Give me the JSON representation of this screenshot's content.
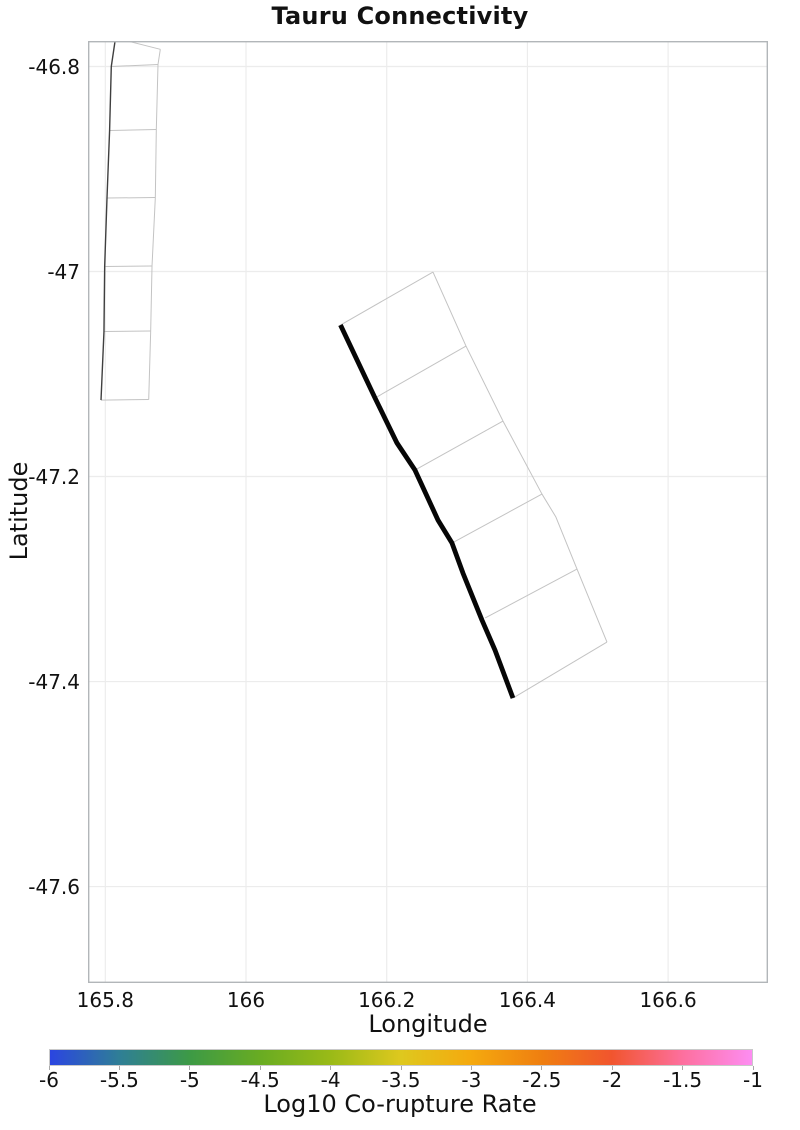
{
  "chart_data": {
    "type": "line",
    "title": "Tauru Connectivity",
    "xlabel": "Longitude",
    "ylabel": "Latitude",
    "xlim": [
      165.7754,
      166.742
    ],
    "ylim": [
      -47.6941,
      -46.7751
    ],
    "xticks": [
      165.8,
      166.0,
      166.2,
      166.4,
      166.6
    ],
    "xtick_labels": [
      "165.8",
      "166",
      "166.2",
      "166.4",
      "166.6"
    ],
    "yticks": [
      -46.8,
      -47.0,
      -47.2,
      -47.4,
      -47.6
    ],
    "ytick_labels": [
      "-46.8",
      "-47",
      "-47.2",
      "-47.4",
      "-47.6"
    ],
    "grid": true,
    "legend": "none",
    "styles": {
      "grid_color": "#ececec",
      "frame_color": "#b2b6b9",
      "mesh_color": "#c3c3c3",
      "thin_trace_color": "#3f3f3f",
      "thick_trace_color": "#060606"
    },
    "series": [
      {
        "name": "west-fault-outline-edge",
        "kind": "polyline",
        "color": "#c3c3c3",
        "width": 1,
        "points": [
          [
            165.8782,
            -46.7832
          ],
          [
            165.8749,
            -46.798
          ],
          [
            165.8725,
            -46.8615
          ],
          [
            165.8711,
            -46.9278
          ],
          [
            165.8664,
            -46.9946
          ],
          [
            165.8645,
            -47.058
          ],
          [
            165.8617,
            -47.1249
          ]
        ]
      },
      {
        "name": "west-fault-rungs",
        "kind": "segments",
        "color": "#c3c3c3",
        "width": 1,
        "segments": [
          [
            [
              165.8145,
              -46.7722
            ],
            [
              165.8782,
              -46.7832
            ]
          ],
          [
            [
              165.8085,
              -46.8
            ],
            [
              165.8749,
              -46.798
            ]
          ],
          [
            [
              165.8061,
              -46.8624
            ],
            [
              165.8725,
              -46.8615
            ]
          ],
          [
            [
              165.8024,
              -46.9283
            ],
            [
              165.8711,
              -46.9278
            ]
          ],
          [
            [
              165.7991,
              -46.9951
            ],
            [
              165.8664,
              -46.9946
            ]
          ],
          [
            [
              165.7981,
              -47.0585
            ],
            [
              165.8645,
              -47.058
            ]
          ],
          [
            [
              165.7939,
              -47.1254
            ],
            [
              165.8617,
              -47.1249
            ]
          ]
        ]
      },
      {
        "name": "west-fault-trace",
        "kind": "polyline",
        "color": "#3f3f3f",
        "width": 1.4,
        "points": [
          [
            165.8145,
            -46.7722
          ],
          [
            165.8085,
            -46.8
          ],
          [
            165.8061,
            -46.8624
          ],
          [
            165.8024,
            -46.9283
          ],
          [
            165.7991,
            -46.9951
          ],
          [
            165.7981,
            -47.0585
          ],
          [
            165.7939,
            -47.1254
          ]
        ]
      },
      {
        "name": "tauru-fault-outline-edge",
        "kind": "polyline",
        "color": "#c3c3c3",
        "width": 1,
        "points": [
          [
            166.2658,
            -47.0005
          ],
          [
            166.3127,
            -47.0727
          ],
          [
            166.3653,
            -47.1459
          ],
          [
            166.4207,
            -47.2171
          ],
          [
            166.4405,
            -47.2395
          ],
          [
            166.4705,
            -47.2903
          ],
          [
            166.5131,
            -47.3615
          ]
        ]
      },
      {
        "name": "tauru-fault-rungs",
        "kind": "segments",
        "color": "#c3c3c3",
        "width": 1,
        "segments": [
          [
            [
              166.1343,
              -47.0522
            ],
            [
              166.2658,
              -47.0005
            ]
          ],
          [
            [
              166.1834,
              -47.1234
            ],
            [
              166.3127,
              -47.0727
            ]
          ],
          [
            [
              166.2402,
              -47.1937
            ],
            [
              166.3653,
              -47.1459
            ]
          ],
          [
            [
              166.2928,
              -47.2649
            ],
            [
              166.4207,
              -47.2171
            ]
          ],
          [
            [
              166.34,
              -47.338
            ],
            [
              166.4705,
              -47.2903
            ]
          ],
          [
            [
              166.3795,
              -47.4161
            ],
            [
              166.5131,
              -47.3615
            ]
          ]
        ]
      },
      {
        "name": "tauru-fault-trace",
        "kind": "polyline",
        "color": "#060606",
        "width": 4.8,
        "points": [
          [
            166.1343,
            -47.0522
          ],
          [
            166.1834,
            -47.1234
          ],
          [
            166.2146,
            -47.1673
          ],
          [
            166.2402,
            -47.1937
          ],
          [
            166.2729,
            -47.2425
          ],
          [
            166.2928,
            -47.2649
          ],
          [
            166.3084,
            -47.2942
          ],
          [
            166.3354,
            -47.34
          ],
          [
            166.3539,
            -47.3693
          ],
          [
            166.3795,
            -47.4161
          ]
        ]
      }
    ],
    "colorbar": {
      "label": "Log10 Co-rupture Rate",
      "min": -6,
      "max": -1,
      "tick_labels": [
        "-6",
        "-5.5",
        "-5",
        "-4.5",
        "-4",
        "-3.5",
        "-3",
        "-2.5",
        "-2",
        "-1.5",
        "-1"
      ],
      "stops": [
        {
          "pos": 0.0,
          "color": "#2b45e1"
        },
        {
          "pos": 0.1,
          "color": "#2f7f95"
        },
        {
          "pos": 0.2,
          "color": "#3d9a45"
        },
        {
          "pos": 0.3,
          "color": "#69ac22"
        },
        {
          "pos": 0.4,
          "color": "#9aba17"
        },
        {
          "pos": 0.5,
          "color": "#dec81e"
        },
        {
          "pos": 0.6,
          "color": "#f5a90e"
        },
        {
          "pos": 0.7,
          "color": "#ef7f10"
        },
        {
          "pos": 0.8,
          "color": "#f1552e"
        },
        {
          "pos": 0.9,
          "color": "#fd6f9d"
        },
        {
          "pos": 1.0,
          "color": "#fd8df2"
        }
      ]
    }
  }
}
